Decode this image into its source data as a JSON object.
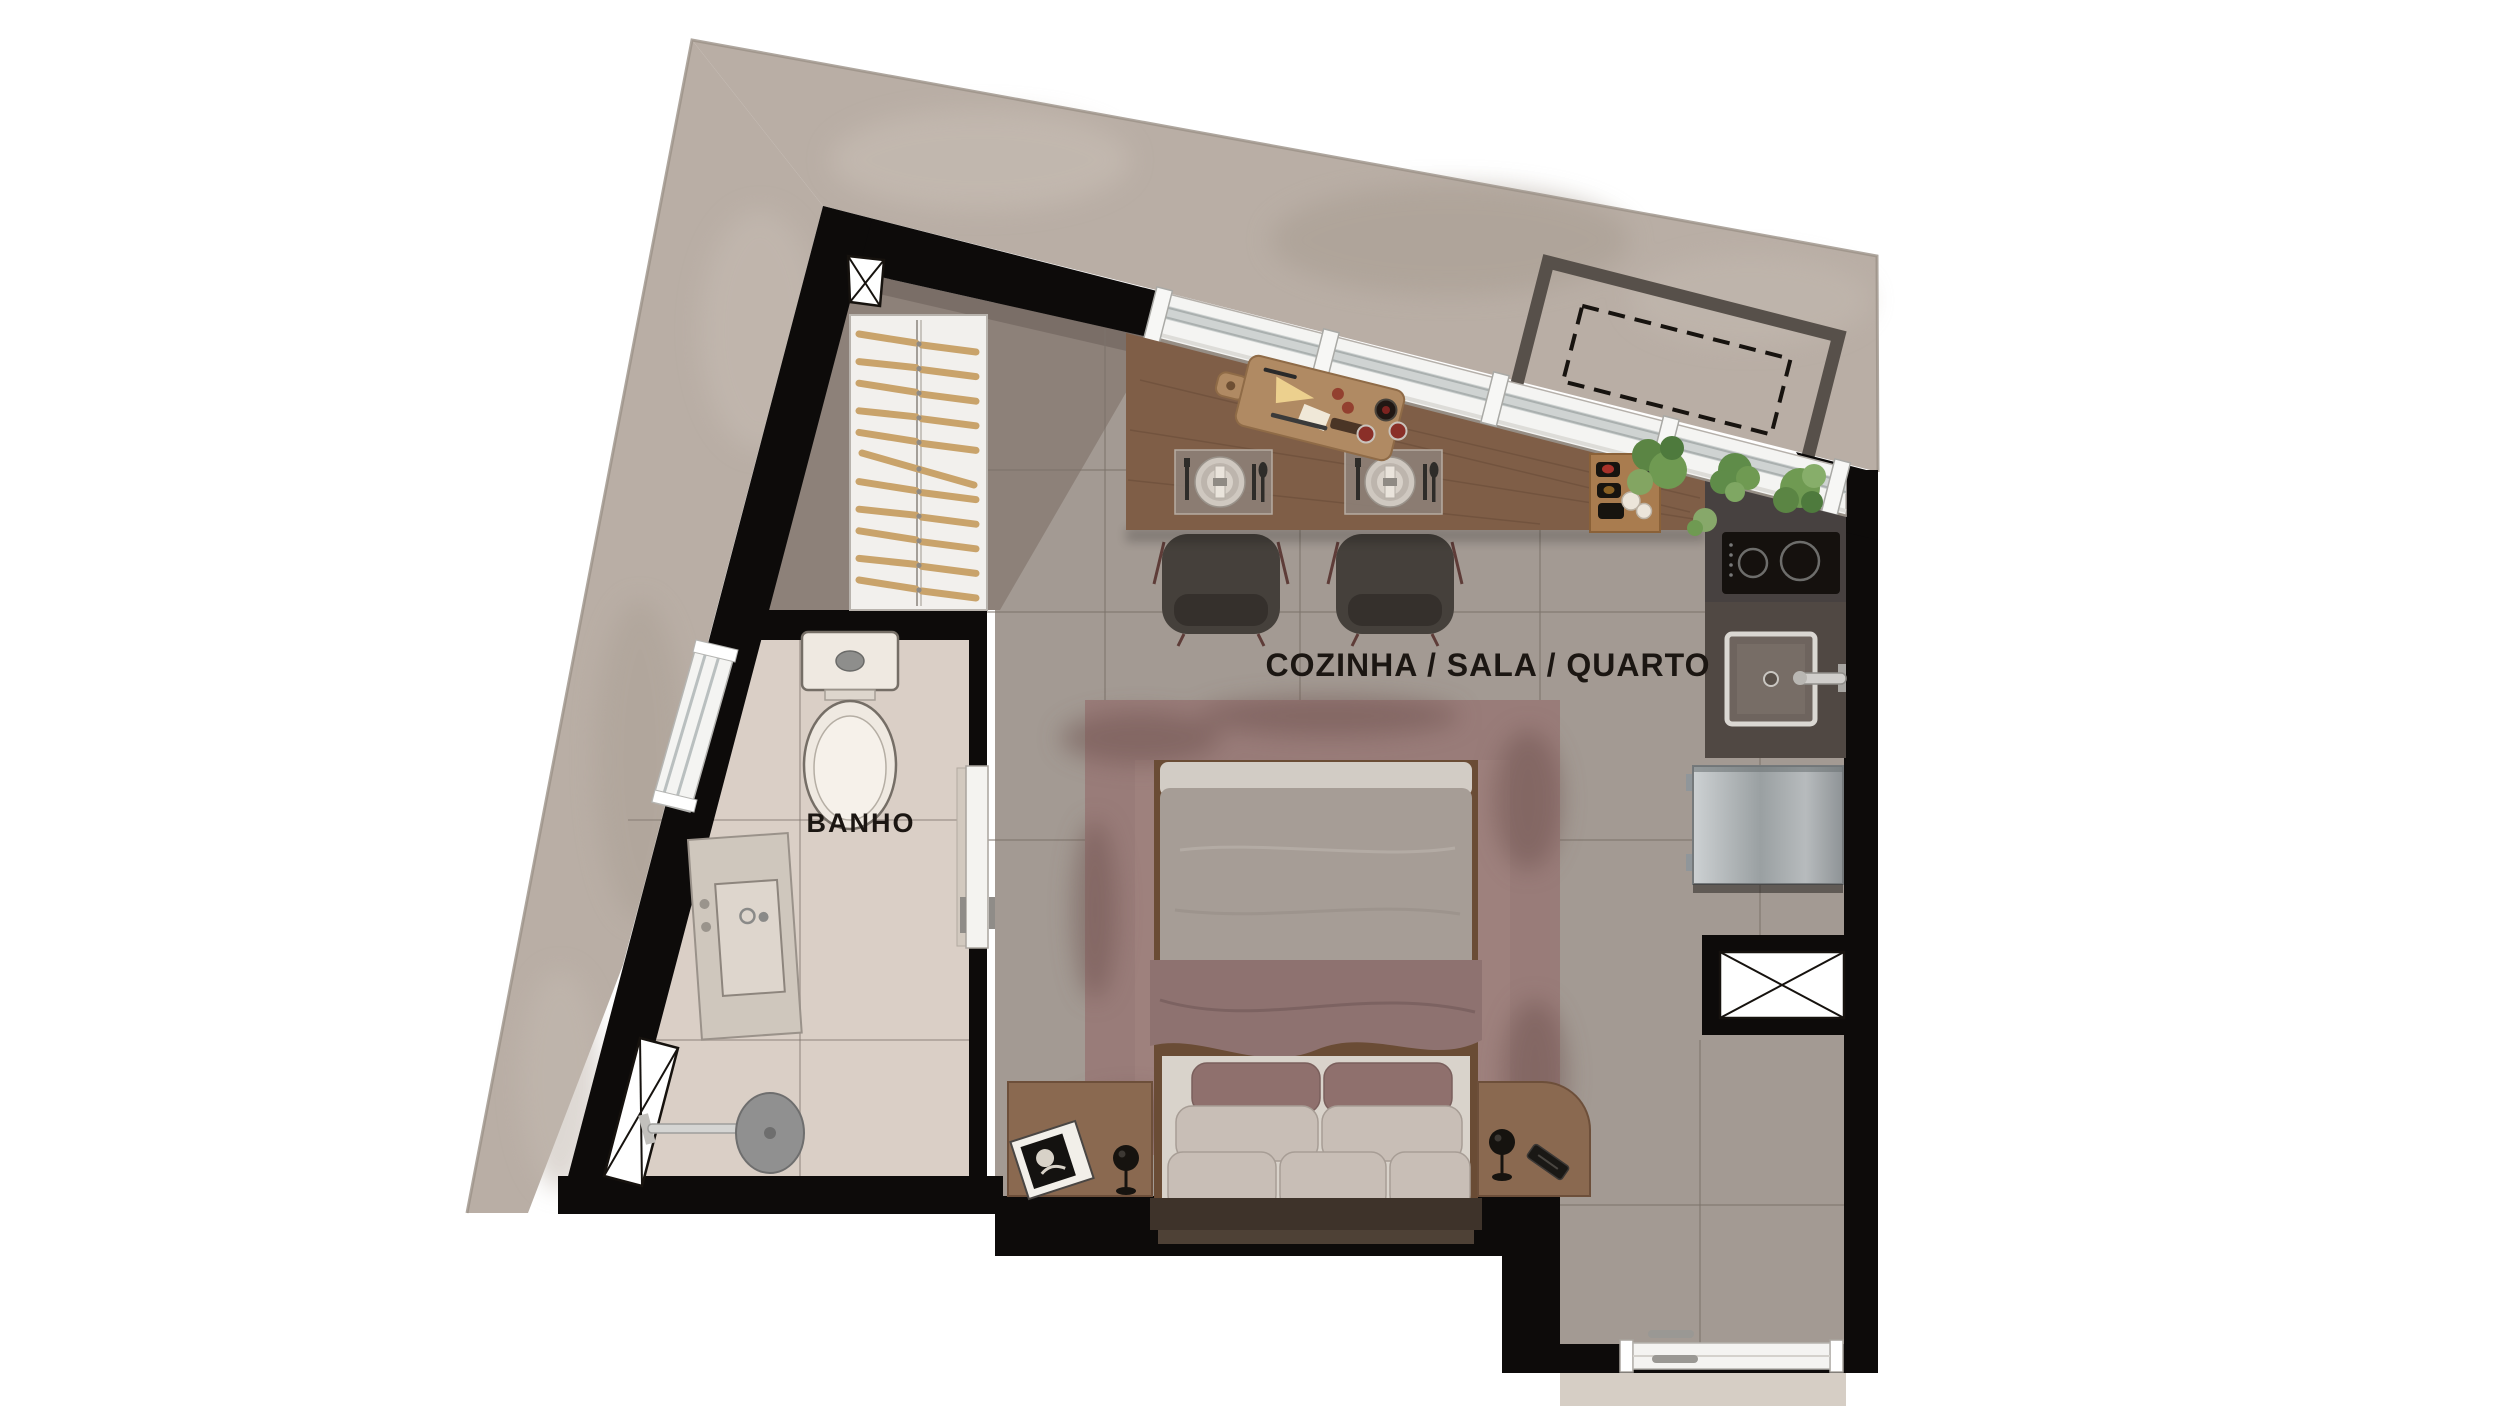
{
  "title": "Studio apartment floor plan",
  "rooms": {
    "main": {
      "label": "COZINHA / SALA / QUARTO"
    },
    "bath": {
      "label": "BANHO"
    }
  },
  "closet": {
    "hanger_count": 11
  },
  "dining": {
    "place_settings": 2,
    "chairs": 2
  },
  "bed": {
    "pillow_rows": [
      2,
      2,
      3
    ]
  },
  "symbols": {
    "shaft_markers": 3,
    "projection_outline": "dashed"
  },
  "colors": {
    "background": "#ffffff",
    "slab": "#b9aea5",
    "slab_light": "#c9bfb6",
    "slab_dark": "#a29789",
    "wall": "#0d0b0a",
    "floor_main": "#a39a93",
    "floor_nook": "#8d8179",
    "floor_bath": "#dacfc6",
    "tile_line": "#7d736b",
    "window": "#f4f4f2",
    "glass": "#cfd3d2",
    "counter_wood": "#7f5e47",
    "counter_dark": "#474140",
    "cooktop": "#15110e",
    "fridge_light": "#cdd1d3",
    "fridge_dark": "#8e9396",
    "rug": "#997c79",
    "rug_dark": "#6e5350",
    "duvet": "#a69d96",
    "duvet_fold": "#d2ccc5",
    "blanket": "#8e7270",
    "sheet": "#d9d3cb",
    "pillow_accent": "#8f706d",
    "pillow_light": "#c8beb6",
    "headboard": "#3e332a",
    "furniture_wood": "#8a6950",
    "chair": "#45403b",
    "chair_leg": "#5e3c38",
    "plant": "#6f9a52",
    "plant_dark": "#4e7a3d",
    "stone": "#cfc7bd",
    "fixture": "#efe9e1",
    "chrome": "#c6c4c0",
    "recess": "#57504a",
    "text": "#1b1612"
  }
}
